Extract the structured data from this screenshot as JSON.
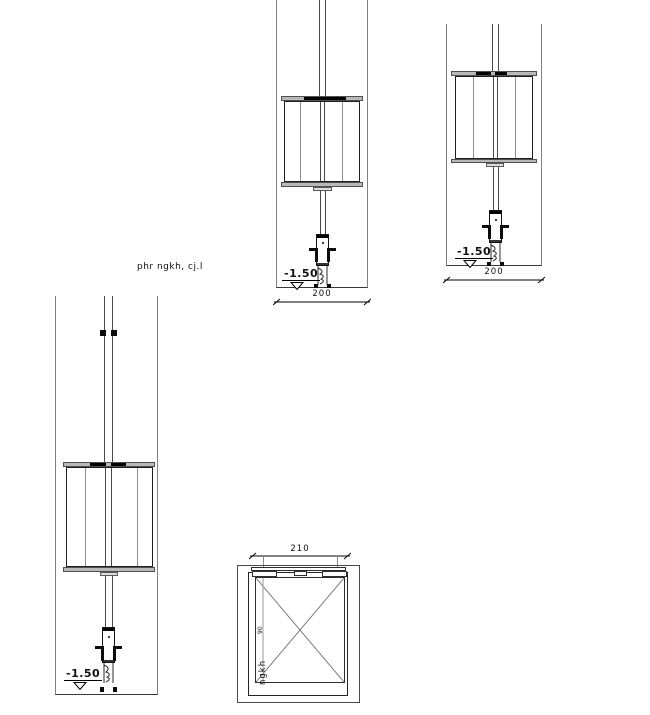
{
  "note": {
    "text": "phr ngkh, cj.l"
  },
  "front_view": {
    "level": "-1.50",
    "width_dim": "200"
  },
  "side_view": {
    "level": "-1.50",
    "width_dim": "200"
  },
  "tall_view": {
    "level": "-1.50"
  },
  "plan_view": {
    "width_dim": "210",
    "depth_dim": "90",
    "label": "ngkh"
  },
  "palette": {
    "line_gray": "#828282",
    "line_dark": "#1f1f1f",
    "cap_fill": "#b9b9b9",
    "background": "#ffffff"
  }
}
